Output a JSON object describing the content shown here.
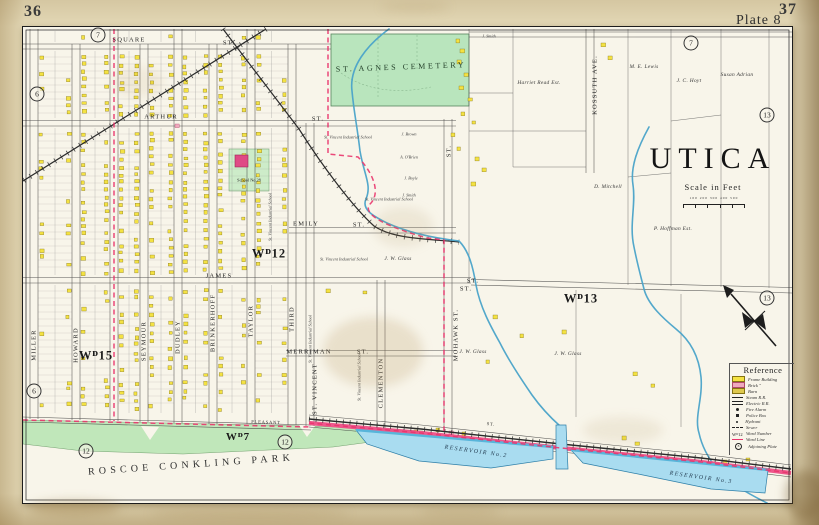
{
  "page": {
    "left_number": "36",
    "right_number": "37",
    "plate_label": "Plate 8"
  },
  "title": {
    "city": "UTICA",
    "scale_label": "Scale in Feet",
    "scale_ticks": "100 200 300 400 500"
  },
  "legend": {
    "title": "Reference",
    "items": [
      {
        "swatch": "frame",
        "label": "Frame Building"
      },
      {
        "swatch": "brick",
        "label": "Brick \""
      },
      {
        "swatch": "barn",
        "label": "Barn"
      },
      {
        "swatch": "steam",
        "label": "Steam R.R."
      },
      {
        "swatch": "electric",
        "label": "Electric R.R."
      },
      {
        "swatch": "fire",
        "label": "Fire Alarm"
      },
      {
        "swatch": "police",
        "label": "Police Box"
      },
      {
        "swatch": "hydrant",
        "label": "Hydrant"
      },
      {
        "swatch": "sewer",
        "label": "Sewer"
      },
      {
        "swatch": "wardnum",
        "label": "Ward Number",
        "text": "Wᴰ12"
      },
      {
        "swatch": "wardline",
        "label": "Ward Line"
      },
      {
        "swatch": "plate",
        "label": "Adjoining Plate",
        "text": "8"
      }
    ]
  },
  "colors": {
    "paper": "#e3d8b6",
    "sheet": "#f8f5ea",
    "ink": "#2b2b2b",
    "frame_building": "#f4e242",
    "frame_stroke": "#80711a",
    "brick_building": "#f0a9be",
    "brick_stroke": "#b04a6a",
    "cemetery_green": "#b9e5bd",
    "park_green": "#c0e7ba",
    "water_fill": "#a9dcf0",
    "water_line": "#4aa3c9",
    "road_pink": "#ee4e87",
    "ward_line": "#e9356d",
    "school_pink": "#df4a85"
  },
  "map_labels": [
    {
      "n": "street-label-square",
      "t": "SQUARE",
      "x": 106,
      "y": 13,
      "c": "st"
    },
    {
      "n": "street-label-square-st",
      "t": "ST.",
      "x": 206,
      "y": 16,
      "c": "st"
    },
    {
      "n": "street-label-arthur",
      "t": "ARTHUR",
      "x": 138,
      "y": 90,
      "c": "st"
    },
    {
      "n": "street-label-arthur-st",
      "t": "ST.",
      "x": 295,
      "y": 92,
      "c": "st"
    },
    {
      "n": "street-label-emily",
      "t": "EMILY",
      "x": 283,
      "y": 197,
      "c": "st"
    },
    {
      "n": "street-label-emily-st",
      "t": "ST.",
      "x": 336,
      "y": 198,
      "c": "st"
    },
    {
      "n": "street-label-james",
      "t": "JAMES",
      "x": 196,
      "y": 249,
      "c": "st"
    },
    {
      "n": "street-label-james-st",
      "t": "ST.",
      "x": 450,
      "y": 254,
      "c": "st"
    },
    {
      "n": "street-label-merriman",
      "t": "MERRIMAN",
      "x": 286,
      "y": 325,
      "c": "st"
    },
    {
      "n": "street-label-merriman-st",
      "t": "ST.",
      "x": 340,
      "y": 325,
      "c": "st"
    },
    {
      "n": "street-label-east-st",
      "t": "ST.",
      "x": 443,
      "y": 262,
      "c": "st"
    },
    {
      "n": "street-label-pleasant",
      "t": "PLEASANT",
      "x": 243,
      "y": 395,
      "r": 2,
      "c": "st tiny2"
    },
    {
      "n": "street-label-road-st",
      "t": "ST.",
      "x": 468,
      "y": 397,
      "r": 6,
      "c": "st tiny2"
    },
    {
      "n": "street-label-miller",
      "t": "MILLER",
      "x": 11,
      "y": 318,
      "r": -90,
      "c": "st"
    },
    {
      "n": "street-label-howard",
      "t": "HOWARD",
      "x": 53,
      "y": 318,
      "r": -90,
      "c": "st"
    },
    {
      "n": "street-label-seymour",
      "t": "SEYMOUR",
      "x": 121,
      "y": 314,
      "r": -90,
      "c": "st"
    },
    {
      "n": "street-label-dudley",
      "t": "DUDLEY",
      "x": 155,
      "y": 310,
      "r": -90,
      "c": "st"
    },
    {
      "n": "street-label-brinkerhoff",
      "t": "BRINKERHOFF",
      "x": 190,
      "y": 296,
      "r": -90,
      "c": "st"
    },
    {
      "n": "street-label-taylor",
      "t": "TAYLOR",
      "x": 228,
      "y": 294,
      "r": -90,
      "c": "st"
    },
    {
      "n": "street-label-third",
      "t": "THIRD",
      "x": 269,
      "y": 292,
      "r": -90,
      "c": "st"
    },
    {
      "n": "street-label-st-vincent",
      "t": "ST. VINCENT",
      "x": 292,
      "y": 362,
      "r": -90,
      "c": "st"
    },
    {
      "n": "street-label-clementon",
      "t": "CLEMENTON",
      "x": 358,
      "y": 356,
      "r": -90,
      "c": "st"
    },
    {
      "n": "street-label-mohawk",
      "t": "MOHAWK ST.",
      "x": 433,
      "y": 308,
      "r": -90,
      "c": "st"
    },
    {
      "n": "street-label-mohawk-north",
      "t": "ST.",
      "x": 426,
      "y": 124,
      "r": -90,
      "c": "st"
    },
    {
      "n": "street-label-kossuth",
      "t": "KOSSUTH AVE.",
      "x": 572,
      "y": 58,
      "r": -90,
      "c": "st"
    },
    {
      "n": "ward-label-12",
      "t": "Wᴰ12",
      "x": 246,
      "y": 227,
      "c": "ward"
    },
    {
      "n": "ward-label-13",
      "t": "Wᴰ13",
      "x": 558,
      "y": 272,
      "c": "ward"
    },
    {
      "n": "ward-label-15",
      "t": "Wᴰ15",
      "x": 73,
      "y": 329,
      "c": "ward"
    },
    {
      "n": "ward-label-7",
      "t": "Wᴰ7",
      "x": 215,
      "y": 410,
      "c": "ward ward-sm"
    },
    {
      "n": "cemetery-label",
      "t": "ST. AGNES CEMETERY",
      "x": 378,
      "y": 40,
      "r": -2,
      "c": "cem"
    },
    {
      "n": "park-label",
      "t": "ROSCOE CONKLING PARK",
      "x": 168,
      "y": 438,
      "r": -4,
      "c": "park"
    },
    {
      "n": "reservoir2-label",
      "t": "RESERVOIR No.2",
      "x": 453,
      "y": 425,
      "r": 8,
      "c": "res"
    },
    {
      "n": "reservoir3-label",
      "t": "RESERVOIR No.3",
      "x": 678,
      "y": 451,
      "r": 8,
      "c": "res"
    },
    {
      "n": "school28-label",
      "t": "School No.28",
      "x": 226,
      "y": 153,
      "c": "school"
    },
    {
      "n": "owner-lewis",
      "t": "M. E. Lewis",
      "x": 621,
      "y": 40,
      "c": "own"
    },
    {
      "n": "owner-hoyt",
      "t": "J. C. Hoyt",
      "x": 666,
      "y": 54,
      "c": "own"
    },
    {
      "n": "owner-adrian",
      "t": "Susan Adrian",
      "x": 714,
      "y": 48,
      "c": "own"
    },
    {
      "n": "owner-hoffman",
      "t": "P. Hoffman Est.",
      "x": 650,
      "y": 202,
      "c": "own"
    },
    {
      "n": "owner-mitchell",
      "t": "D. Mitchell",
      "x": 585,
      "y": 160,
      "c": "own"
    },
    {
      "n": "owner-glass-1",
      "t": "J. W. Glass",
      "x": 375,
      "y": 232,
      "c": "own"
    },
    {
      "n": "owner-glass-2",
      "t": "J. W. Glass",
      "x": 450,
      "y": 325,
      "c": "own"
    },
    {
      "n": "owner-glass-3",
      "t": "J. W. Glass",
      "x": 545,
      "y": 327,
      "c": "own"
    },
    {
      "n": "owner-read",
      "t": "Harriet Read Est.",
      "x": 516,
      "y": 56,
      "c": "own"
    },
    {
      "n": "owner-brown",
      "t": "J. Brown",
      "x": 386,
      "y": 107,
      "c": "own-t"
    },
    {
      "n": "owner-obrien",
      "t": "A. O'Brien",
      "x": 386,
      "y": 130,
      "c": "own-t"
    },
    {
      "n": "owner-boyle",
      "t": "J. Boyle",
      "x": 388,
      "y": 151,
      "c": "own-t"
    },
    {
      "n": "owner-smith-1",
      "t": "J. Smith",
      "x": 386,
      "y": 168,
      "c": "own-t"
    },
    {
      "n": "owner-smith-2",
      "t": "J. Smith",
      "x": 466,
      "y": 9,
      "c": "own-t"
    },
    {
      "n": "school-stvincent-1",
      "t": "St. Vincent Industrial School",
      "x": 325,
      "y": 110,
      "c": "own-t"
    },
    {
      "n": "school-stvincent-2",
      "t": "St. Vincent Industrial School",
      "x": 366,
      "y": 172,
      "c": "own-t"
    },
    {
      "n": "school-stvincent-3",
      "t": "St. Vincent Industrial School",
      "x": 321,
      "y": 232,
      "c": "own-t"
    },
    {
      "n": "school-stvincent-4",
      "t": "St. Vincent Industrial School",
      "x": 247,
      "y": 190,
      "r": -90,
      "c": "own-t"
    },
    {
      "n": "school-stvincent-5",
      "t": "St. Vincent Industrial School",
      "x": 287,
      "y": 312,
      "r": -90,
      "c": "own-t"
    },
    {
      "n": "school-stvincent-6",
      "t": "St. Vincent Industrial School",
      "x": 336,
      "y": 350,
      "r": -90,
      "c": "own-t"
    }
  ],
  "plate_refs": [
    {
      "n": "adjoining-plate-7-left",
      "v": "7",
      "x": 75,
      "y": 8
    },
    {
      "n": "adjoining-plate-7-right",
      "v": "7",
      "x": 668,
      "y": 16
    },
    {
      "n": "adjoining-plate-13-upper",
      "v": "13",
      "x": 744,
      "y": 88
    },
    {
      "n": "adjoining-plate-13-lower",
      "v": "13",
      "x": 744,
      "y": 271
    },
    {
      "n": "adjoining-plate-12-left",
      "v": "12",
      "x": 63,
      "y": 424
    },
    {
      "n": "adjoining-plate-12-right",
      "v": "12",
      "x": 262,
      "y": 415
    },
    {
      "n": "adjoining-plate-6-upper",
      "v": "6",
      "x": 14,
      "y": 67
    },
    {
      "n": "adjoining-plate-6-lower",
      "v": "6",
      "x": 11,
      "y": 364
    }
  ]
}
